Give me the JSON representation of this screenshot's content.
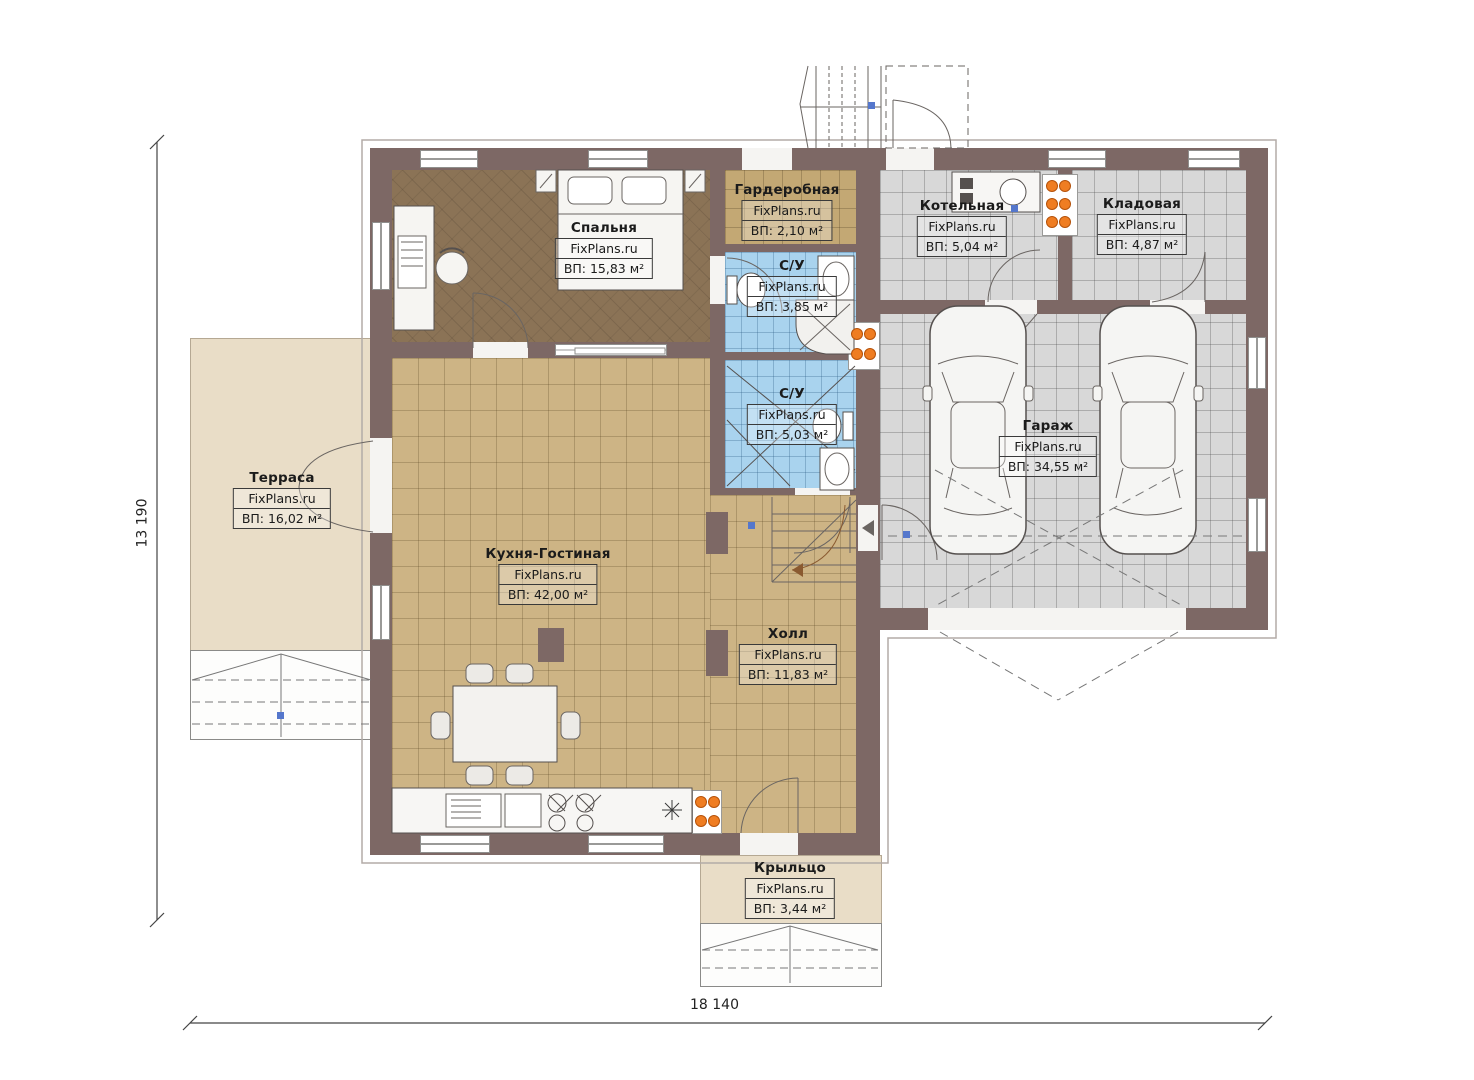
{
  "plan": {
    "watermark": "FixPlans.ru",
    "dimensions": {
      "height_label": "13 190",
      "width_label": "18 140"
    },
    "rooms": [
      {
        "id": "bedroom",
        "name": "Спальня",
        "area": "ВП: 15,83 м²"
      },
      {
        "id": "wardrobe",
        "name": "Гардеробная",
        "area": "ВП: 2,10 м²"
      },
      {
        "id": "bathroom-1",
        "name": "С/У",
        "area": "ВП: 3,85 м²"
      },
      {
        "id": "bathroom-2",
        "name": "С/У",
        "area": "ВП: 5,03 м²"
      },
      {
        "id": "boiler-room",
        "name": "Котельная",
        "area": "ВП: 5,04 м²"
      },
      {
        "id": "storage",
        "name": "Кладовая",
        "area": "ВП: 4,87 м²"
      },
      {
        "id": "garage",
        "name": "Гараж",
        "area": "ВП: 34,55 м²"
      },
      {
        "id": "kitchen-living",
        "name": "Кухня-Гостиная",
        "area": "ВП: 42,00 м²"
      },
      {
        "id": "hall",
        "name": "Холл",
        "area": "ВП: 11,83 м²"
      },
      {
        "id": "terrace",
        "name": "Терраса",
        "area": "ВП: 16,02 м²"
      },
      {
        "id": "porch",
        "name": "Крыльцо",
        "area": "ВП: 3,44 м²"
      }
    ],
    "colors": {
      "wall": "#7d6865",
      "tile_tan": "#cdb485",
      "tile_blue": "#a9d3ee",
      "tile_gray": "#d8d8d8",
      "floor_bedroom": "#8b7356",
      "outdoor": "#e9ddc7",
      "radiator": "#ef7d22"
    }
  }
}
